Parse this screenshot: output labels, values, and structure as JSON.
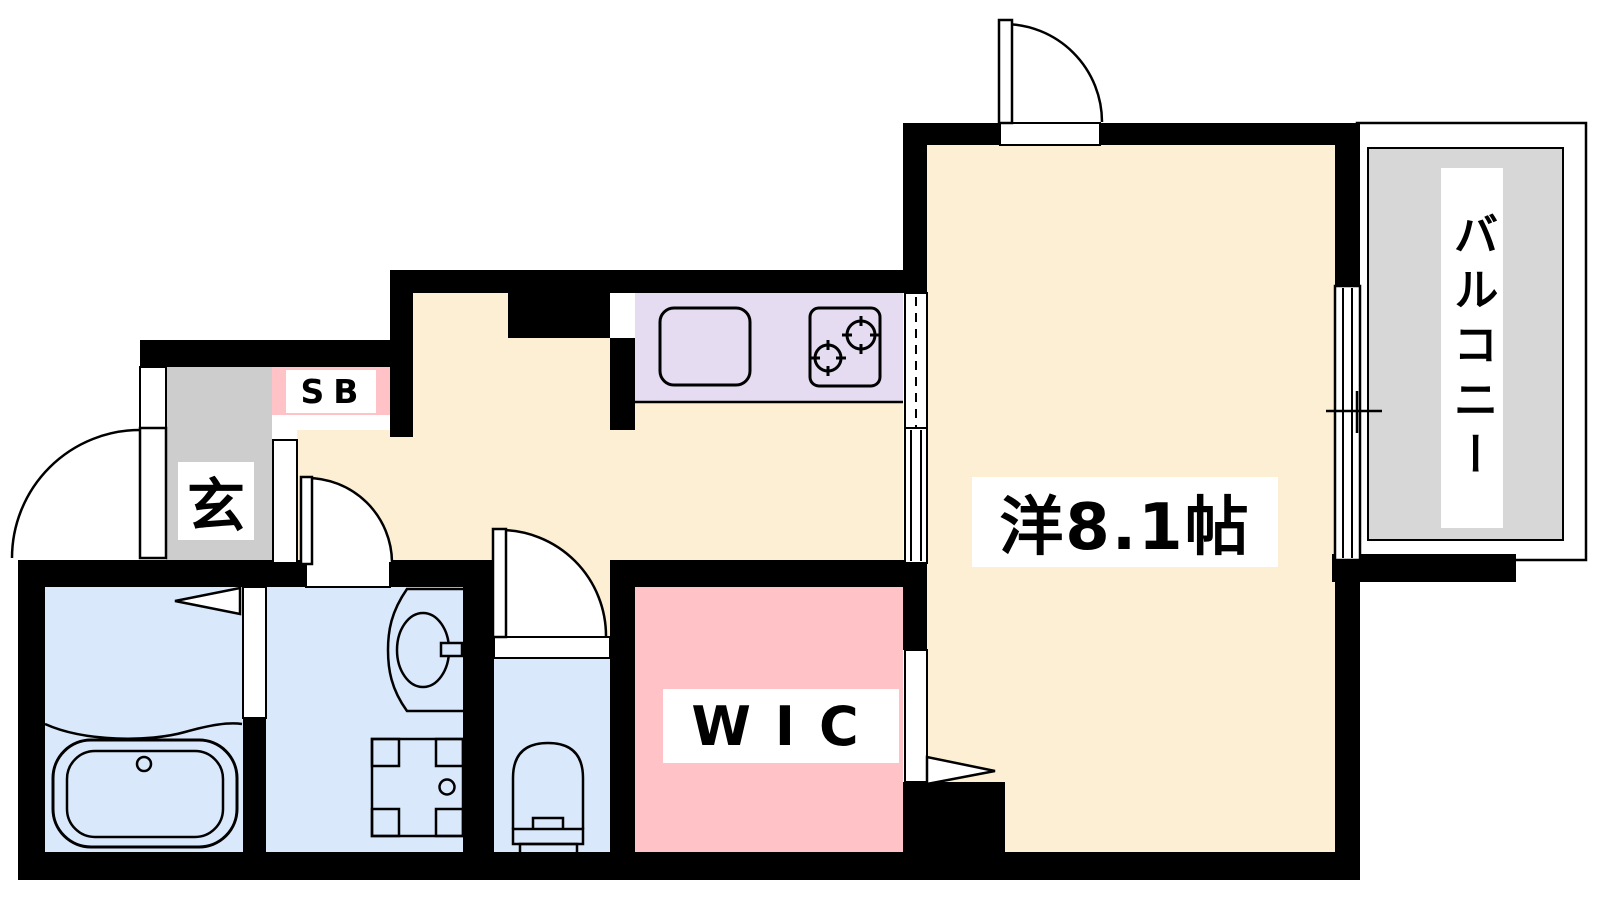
{
  "plan": {
    "type": "apartment-floor-plan",
    "rooms": {
      "main_room": {
        "label": "洋8.1帖"
      },
      "balcony": {
        "label": "バルコニー"
      },
      "entrance": {
        "label": "玄"
      },
      "shoe_box": {
        "label": "SB"
      },
      "walk_in_closet": {
        "label": "WIC"
      }
    },
    "fixtures": [
      "bathtub",
      "vanity-sink",
      "washing-machine-pan",
      "toilet",
      "kitchen-sink",
      "stove-2-burner",
      "hinged-doors",
      "sliding-door",
      "balcony-window"
    ],
    "colors": {
      "wall": "#000000",
      "room_floor": "#FCEFD3",
      "kitchen_counter": "#E5DCF2",
      "wet_area": "#D9E8FA",
      "closet": "#FFC2C7",
      "entrance_gray": "#CDCDCD",
      "balcony_gray": "#D7D7D7",
      "line": "#000000",
      "background": "#FFFFFF"
    }
  }
}
